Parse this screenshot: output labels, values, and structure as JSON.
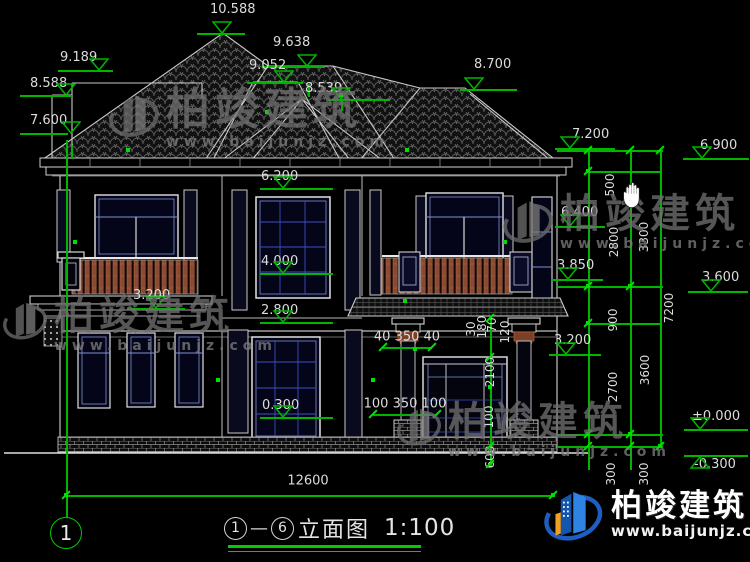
{
  "app": {
    "background": "#000000",
    "accent_green": "#00b400",
    "line_color": "#d9d9d9",
    "cursor_icon": "hand"
  },
  "watermark": {
    "brand": "柏竣建筑",
    "site": "www.baijunjz.com"
  },
  "logo": {
    "brand": "柏竣建筑",
    "site": "www.baijunjz.com"
  },
  "title": {
    "axis_start": "1",
    "axis_end": "6",
    "name": "立面图",
    "scale": "1:100"
  },
  "axis_bubble": {
    "label": "1"
  },
  "drawing": {
    "elevation_markers": [
      {
        "label": "10.588",
        "tx": 210,
        "ty": 3,
        "lx": 197,
        "ly": 33,
        "lw": 48,
        "cx": 222
      },
      {
        "label": "9.638",
        "tx": 273,
        "ty": 36,
        "lx": 262,
        "ly": 66,
        "lw": 62,
        "cx": 307
      },
      {
        "label": "9.052",
        "tx": 249,
        "ty": 59,
        "lx": 248,
        "ly": 82,
        "lw": 55,
        "cx": 284
      },
      {
        "label": "8.539",
        "tx": 305,
        "ty": 82,
        "lx": 328,
        "ly": 99,
        "lw": 62,
        "cx": 341
      },
      {
        "label": "9.189",
        "tx": 60,
        "ty": 51,
        "lx": 58,
        "ly": 70,
        "lw": 55,
        "cx": 99
      },
      {
        "label": "8.588",
        "tx": 30,
        "ty": 77,
        "lx": 20,
        "ly": 95,
        "lw": 52,
        "cx": 66
      },
      {
        "label": "7.600",
        "tx": 30,
        "ty": 114,
        "lx": 20,
        "ly": 133,
        "lw": 48,
        "cx": 71
      },
      {
        "label": "8.700",
        "tx": 474,
        "ty": 58,
        "lx": 460,
        "ly": 89,
        "lw": 57,
        "cx": 474
      },
      {
        "label": "7.200",
        "tx": 572,
        "ty": 128,
        "lx": 555,
        "ly": 148,
        "lw": 60,
        "cx": 570
      },
      {
        "label": "6.900",
        "tx": 700,
        "ty": 139,
        "lx": 683,
        "ly": 158,
        "lw": 66,
        "cx": 702
      },
      {
        "label": "6.400",
        "tx": 561,
        "ty": 206,
        "lx": 555,
        "ly": 226,
        "lw": 50,
        "cx": 570
      },
      {
        "label": "3.850",
        "tx": 557,
        "ty": 259,
        "lx": 551,
        "ly": 279,
        "lw": 52,
        "cx": 568
      },
      {
        "label": "3.600",
        "tx": 702,
        "ty": 271,
        "lx": 688,
        "ly": 291,
        "lw": 60,
        "cx": 711
      },
      {
        "label": "3.200",
        "tx": 133,
        "ty": 289,
        "lx": 127,
        "ly": 308,
        "lw": 58,
        "cx": 156
      },
      {
        "label": "3.200",
        "tx": 554,
        "ty": 334,
        "lx": 549,
        "ly": 354,
        "lw": 52,
        "cx": 566
      },
      {
        "label": "6.200",
        "tx": 261,
        "ty": 170,
        "lx": 260,
        "ly": 188,
        "lw": 73,
        "cx": 283
      },
      {
        "label": "4.000",
        "tx": 261,
        "ty": 255,
        "lx": 260,
        "ly": 273,
        "lw": 73,
        "cx": 283
      },
      {
        "label": "2.800",
        "tx": 261,
        "ty": 304,
        "lx": 260,
        "ly": 322,
        "lw": 73,
        "cx": 283
      },
      {
        "label": "0.300",
        "tx": 262,
        "ty": 399,
        "lx": 260,
        "ly": 417,
        "lw": 73,
        "cx": 283
      },
      {
        "label": "±0.000",
        "tx": 692,
        "ty": 410,
        "lx": 684,
        "ly": 429,
        "lw": 64,
        "cx": 700
      },
      {
        "label": "-0.300",
        "tx": 694,
        "ty": 458,
        "lx": 684,
        "ly": 455,
        "lw": 64,
        "cx": 700,
        "flip": true
      }
    ],
    "rotated_dims": [
      {
        "label": "500",
        "x": 610,
        "y": 185
      },
      {
        "label": "2800",
        "x": 614,
        "y": 242
      },
      {
        "label": "3300",
        "x": 644,
        "y": 237
      },
      {
        "label": "900",
        "x": 613,
        "y": 320
      },
      {
        "label": "7200",
        "x": 669,
        "y": 308
      },
      {
        "label": "2700",
        "x": 613,
        "y": 387
      },
      {
        "label": "3600",
        "x": 645,
        "y": 370
      },
      {
        "label": "300",
        "x": 611,
        "y": 474
      },
      {
        "label": "300",
        "x": 644,
        "y": 474
      },
      {
        "label": "30",
        "x": 471,
        "y": 329
      },
      {
        "label": "180",
        "x": 482,
        "y": 327
      },
      {
        "label": "70",
        "x": 492,
        "y": 325
      },
      {
        "label": "120",
        "x": 505,
        "y": 332
      },
      {
        "label": "2100",
        "x": 490,
        "y": 372
      },
      {
        "label": "100",
        "x": 489,
        "y": 417
      },
      {
        "label": "600",
        "x": 490,
        "y": 457
      }
    ],
    "horizontal_dims": [
      {
        "label": "12600",
        "x": 308,
        "y": 481
      },
      {
        "label": "40 350 40",
        "x": 407,
        "y": 337
      },
      {
        "label": "100 350 100",
        "x": 405,
        "y": 404
      }
    ]
  },
  "annotations": {
    "vlines": [
      {
        "x": 66,
        "y": 140,
        "h": 377
      },
      {
        "x": 588,
        "y": 150,
        "h": 320
      },
      {
        "x": 630,
        "y": 150,
        "h": 320
      },
      {
        "x": 660,
        "y": 150,
        "h": 296
      },
      {
        "x": 490,
        "y": 316,
        "h": 151
      },
      {
        "x": 308,
        "y": 84,
        "h": 13
      },
      {
        "x": 341,
        "y": 99,
        "h": 12
      },
      {
        "x": 71,
        "y": 145,
        "h": 14
      }
    ],
    "hlines": [
      {
        "x": 66,
        "y": 495,
        "w": 487
      },
      {
        "x": 557,
        "y": 150,
        "w": 106
      },
      {
        "x": 588,
        "y": 171,
        "w": 74
      },
      {
        "x": 557,
        "y": 286,
        "w": 106
      },
      {
        "x": 588,
        "y": 323,
        "w": 74
      },
      {
        "x": 557,
        "y": 434,
        "w": 106
      },
      {
        "x": 557,
        "y": 446,
        "w": 106
      },
      {
        "x": 383,
        "y": 347,
        "w": 49
      },
      {
        "x": 373,
        "y": 414,
        "w": 64
      }
    ],
    "ticks": [
      {
        "x": 66,
        "y": 495
      },
      {
        "x": 553,
        "y": 495
      },
      {
        "x": 588,
        "y": 150
      },
      {
        "x": 630,
        "y": 150
      },
      {
        "x": 660,
        "y": 150
      },
      {
        "x": 588,
        "y": 171
      },
      {
        "x": 588,
        "y": 286
      },
      {
        "x": 630,
        "y": 286
      },
      {
        "x": 588,
        "y": 323
      },
      {
        "x": 588,
        "y": 434
      },
      {
        "x": 630,
        "y": 434
      },
      {
        "x": 588,
        "y": 446
      },
      {
        "x": 630,
        "y": 446
      },
      {
        "x": 660,
        "y": 446
      },
      {
        "x": 383,
        "y": 347
      },
      {
        "x": 432,
        "y": 347
      },
      {
        "x": 373,
        "y": 414
      },
      {
        "x": 437,
        "y": 414
      },
      {
        "x": 490,
        "y": 318
      },
      {
        "x": 490,
        "y": 357
      },
      {
        "x": 490,
        "y": 446
      },
      {
        "x": 490,
        "y": 464
      }
    ],
    "dots": [
      {
        "x": 128,
        "y": 150
      },
      {
        "x": 407,
        "y": 150
      },
      {
        "x": 267,
        "y": 112
      },
      {
        "x": 341,
        "y": 95
      },
      {
        "x": 75,
        "y": 242
      },
      {
        "x": 505,
        "y": 242
      },
      {
        "x": 405,
        "y": 301
      },
      {
        "x": 218,
        "y": 380
      },
      {
        "x": 373,
        "y": 380
      },
      {
        "x": 66,
        "y": 495
      },
      {
        "x": 553,
        "y": 495
      },
      {
        "x": 588,
        "y": 171
      },
      {
        "x": 588,
        "y": 286
      },
      {
        "x": 588,
        "y": 323
      },
      {
        "x": 630,
        "y": 286
      },
      {
        "x": 588,
        "y": 434
      },
      {
        "x": 630,
        "y": 434
      },
      {
        "x": 660,
        "y": 446
      },
      {
        "x": 490,
        "y": 387
      },
      {
        "x": 415,
        "y": 349
      }
    ]
  }
}
